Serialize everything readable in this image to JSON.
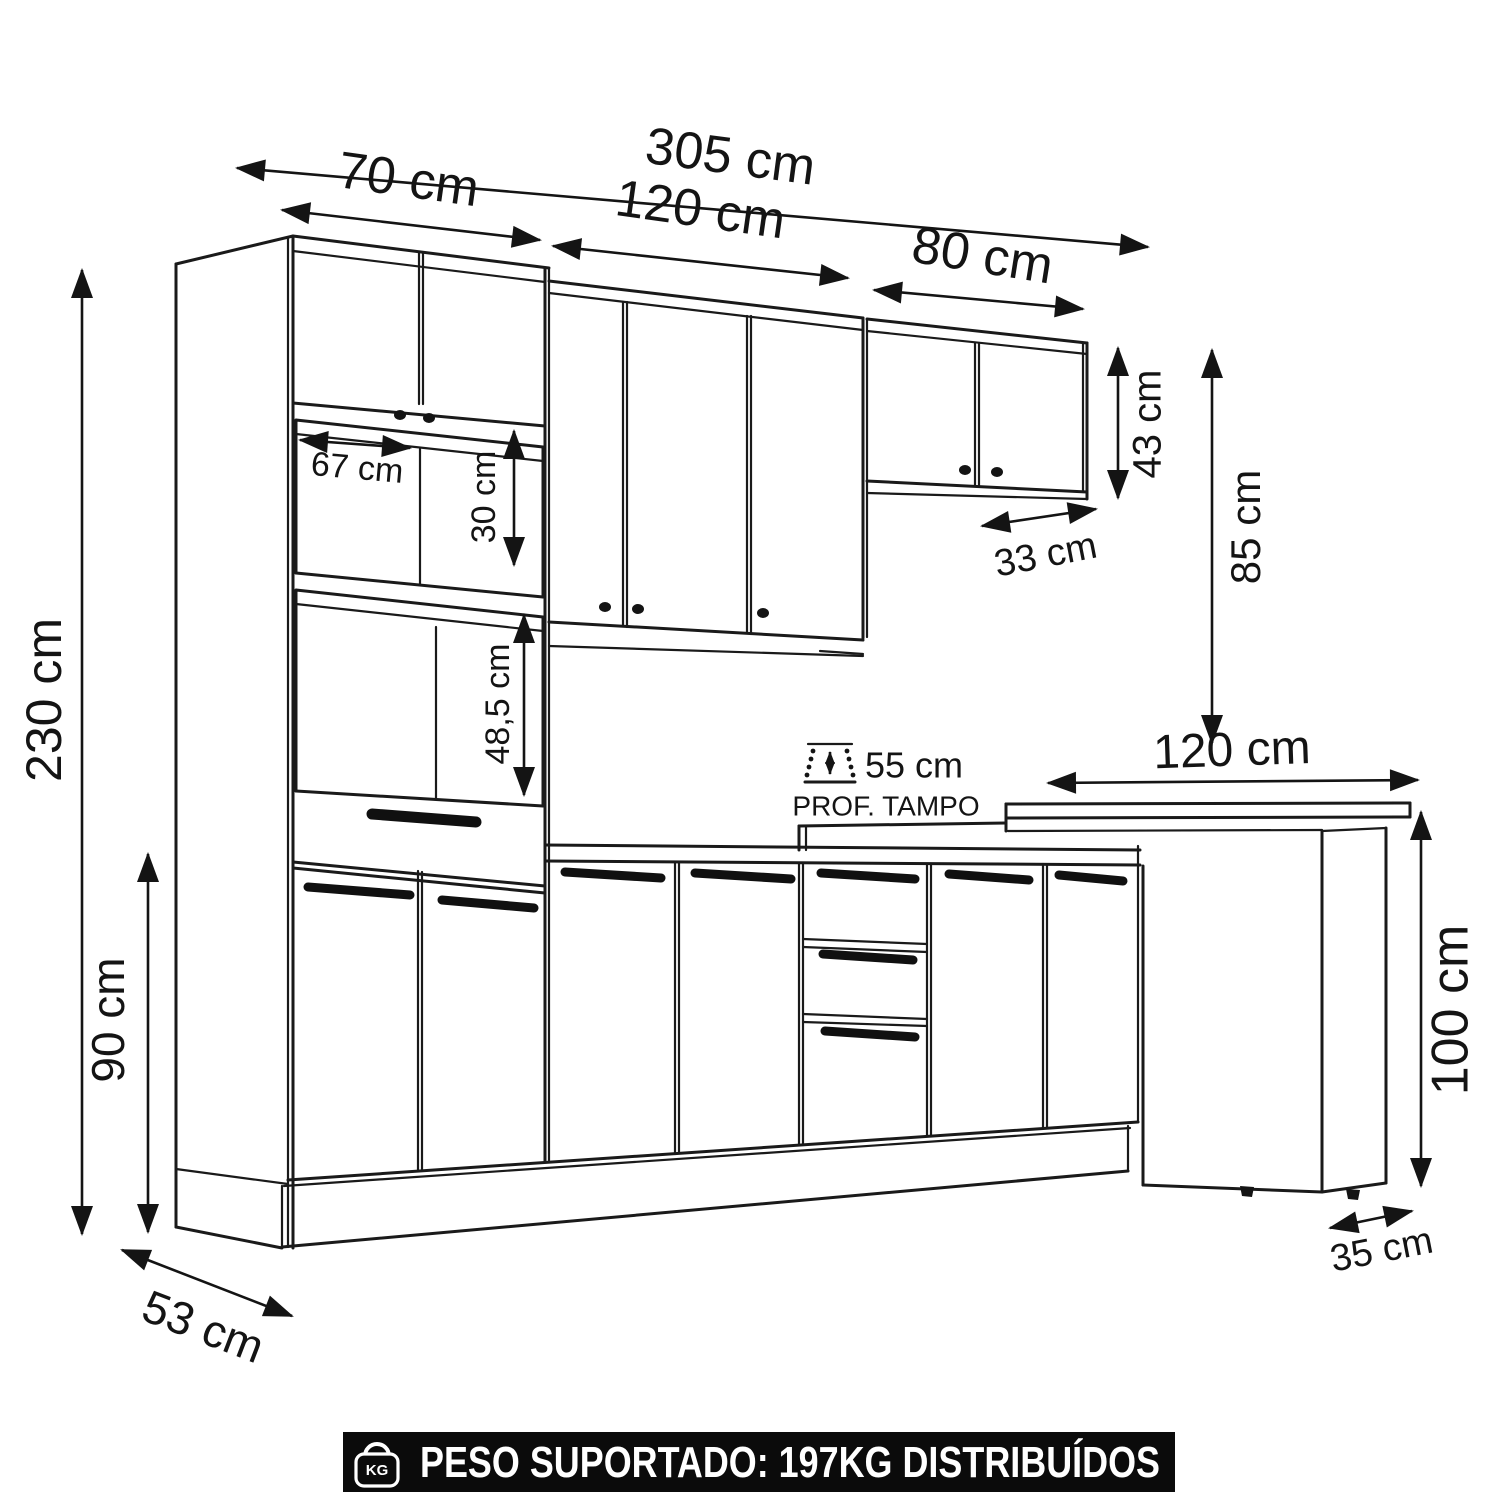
{
  "diagram": {
    "type": "kitchen-cabinet-set-technical-drawing",
    "unit": "cm",
    "dims": {
      "d305": "305 cm",
      "d70": "70 cm",
      "d120": "120 cm",
      "d80": "80 cm",
      "d230": "230 cm",
      "d90": "90 cm",
      "d67": "67 cm",
      "d30": "30 cm",
      "d485": "48,5 cm",
      "d43": "43 cm",
      "d85": "85 cm",
      "d33": "33 cm",
      "d55": "55 cm",
      "prof_tampo": "PROF. TAMPO",
      "d120_bar": "120 cm",
      "d100": "100 cm",
      "d53": "53 cm",
      "d35": "35 cm"
    },
    "banner": {
      "icon_label": "KG",
      "text": "PESO SUPORTADO: 197KG DISTRIBUÍDOS"
    },
    "colors": {
      "line": "#1a1a1a",
      "background": "#ffffff",
      "banner_bg": "#0b0b0b",
      "banner_text": "#ffffff"
    }
  }
}
